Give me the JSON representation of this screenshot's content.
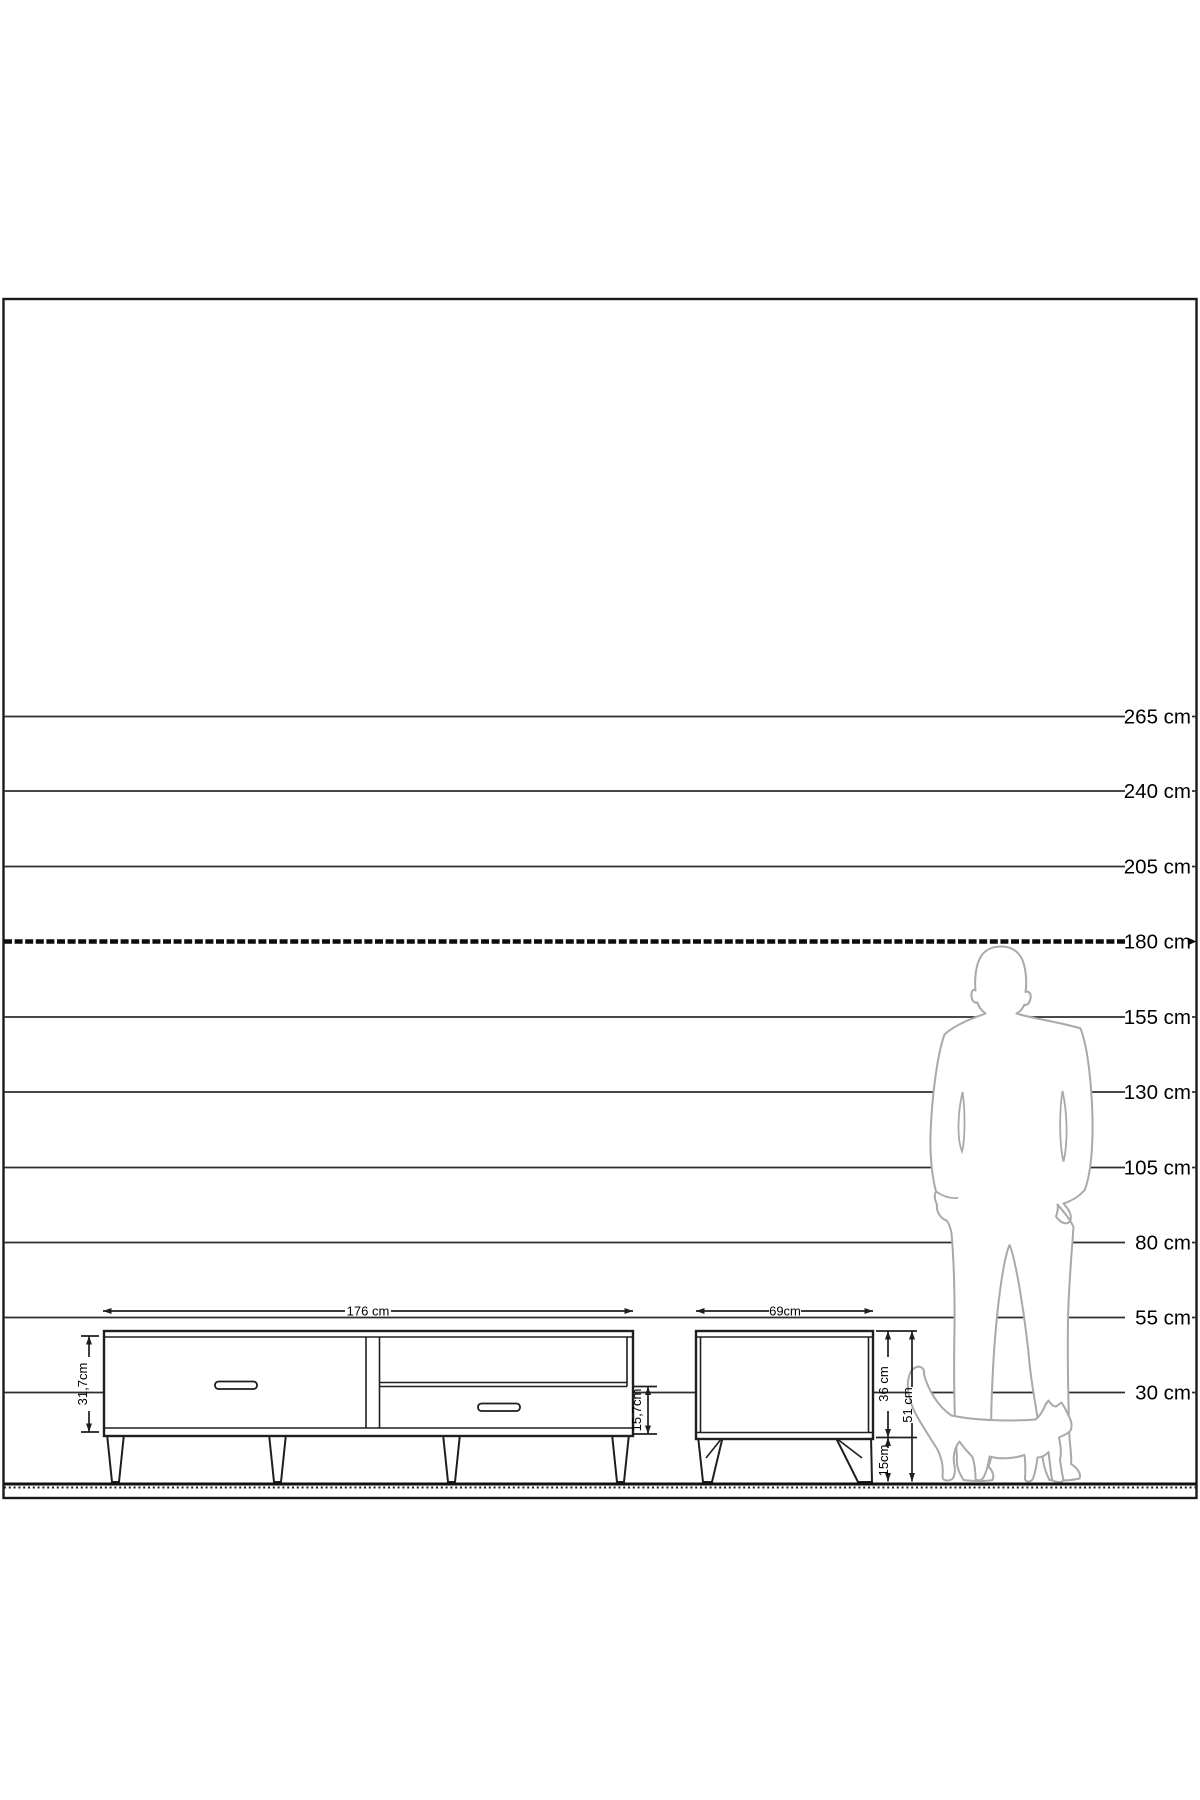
{
  "colors": {
    "ink": "#1f1f1f",
    "scale_line": "#2e2e2e",
    "silhouette_outline": "#a9a9a9",
    "background": "#ffffff"
  },
  "scale_ruler": {
    "unit": "cm",
    "values": [
      265,
      240,
      205,
      180,
      155,
      130,
      105,
      80,
      55,
      30
    ],
    "labels": [
      "265 cm",
      "240 cm",
      "205 cm",
      "180 cm",
      "155 cm",
      "130 cm",
      "105 cm",
      "80 cm",
      "55 cm",
      "30 cm"
    ],
    "emphasized_label": "180 cm"
  },
  "tv_stand": {
    "width_label": "176 cm",
    "body_height_label": "31,7cm",
    "drawer_height_label": "15,7cm"
  },
  "side_table": {
    "width_label": "69cm",
    "body_height_label": "36 cm",
    "leg_height_label": "15cm",
    "total_height_label": "51 cm"
  }
}
